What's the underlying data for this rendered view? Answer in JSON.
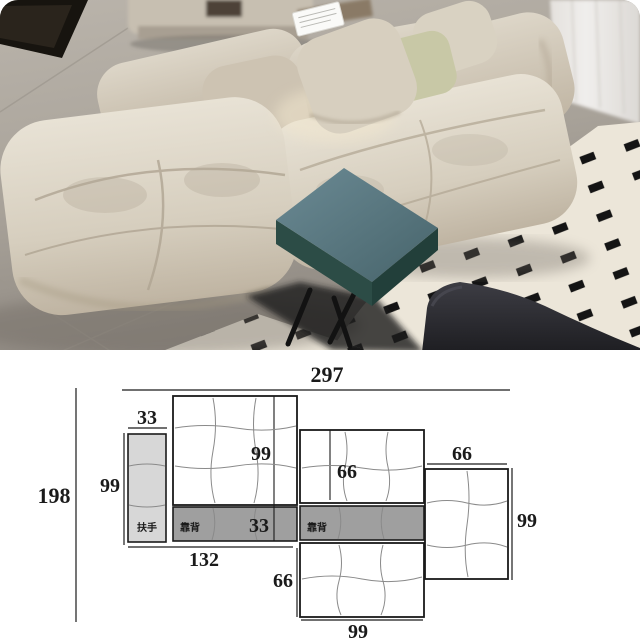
{
  "photo": {
    "description": "Beige modular tufted fabric sofa in a showroom, teal square side table, cream rug with black block pattern, sheer curtain, dark lounge chair",
    "colors": {
      "sofa_light": "#e6e0d3",
      "sofa_dark": "#c3b9a8",
      "floor_light": "#b8b2a9",
      "floor_dark": "#8f8981",
      "rug": "#ece6d9",
      "rug_mark": "#141414",
      "curtain": "#eceae7",
      "table_top": "#64828c",
      "table_side": "#2c4c46",
      "chair": "#2b2b2f",
      "pillow_beige": "#d7cfbf",
      "pillow_sage": "#c8c8a6",
      "tag_card": "#fafaf8"
    }
  },
  "diagram": {
    "background": "#ffffff",
    "line_color": "#1a1a1a",
    "tuft_line_color": "#8a8a8a",
    "armrest_fill": "#d7d7d7",
    "backrest_fill": "#9f9f9f",
    "dims": {
      "total_width": "297",
      "total_depth": "198",
      "armrest_width": "33",
      "armrest_length": "99",
      "left_seat_width": "99",
      "left_section_width": "132",
      "backrest_depth": "33",
      "mid_seat_width": "66",
      "ottoman_depth": "66",
      "ottoman_width": "99",
      "right_seat_width": "66",
      "right_seat_depth": "99"
    },
    "labels": {
      "armrest": "扶手",
      "backrest": "靠背"
    }
  }
}
